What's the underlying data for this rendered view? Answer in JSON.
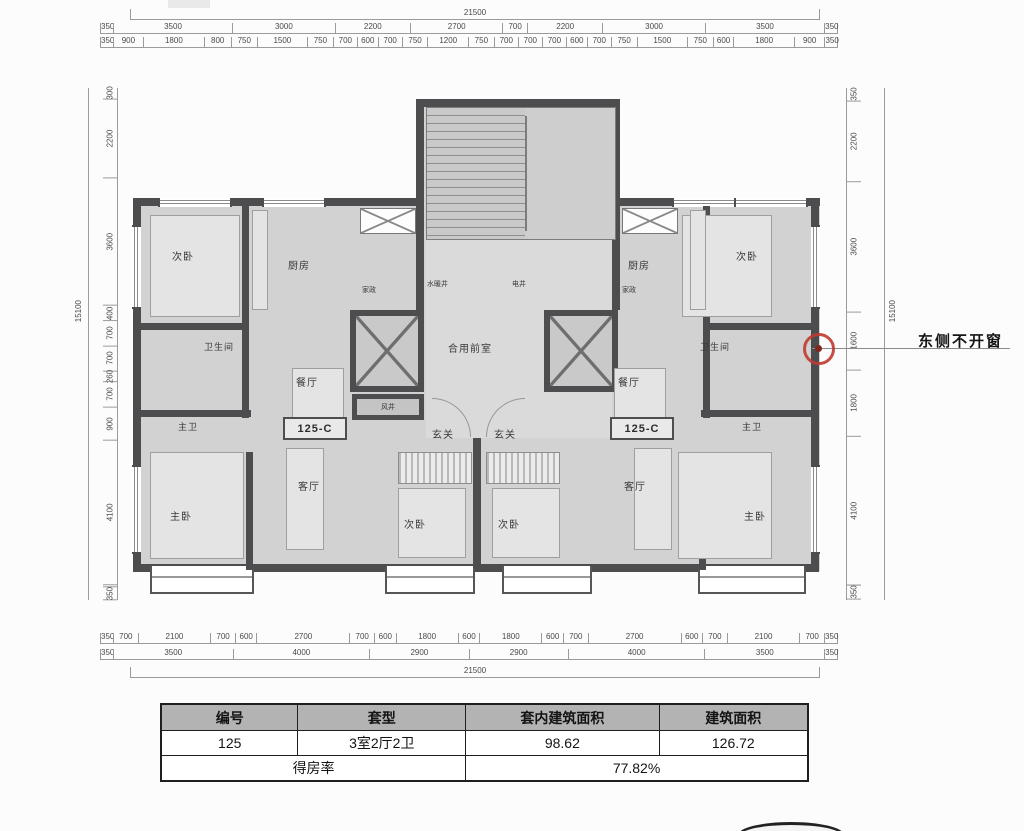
{
  "dims": {
    "top": {
      "total": "21500",
      "row2": [
        "350",
        "3500",
        "3000",
        "2200",
        "2700",
        "700",
        "2200",
        "3000",
        "3500",
        "350"
      ],
      "row3": [
        "350",
        "900",
        "1800",
        "800",
        "750",
        "1500",
        "750",
        "700",
        "600",
        "700",
        "750",
        "1200",
        "750",
        "700",
        "700",
        "700",
        "600",
        "700",
        "750",
        "1500",
        "750",
        "600",
        "1800",
        "900",
        "350"
      ]
    },
    "bottom": {
      "row1": [
        "350",
        "700",
        "2100",
        "700",
        "600",
        "2700",
        "700",
        "600",
        "1800",
        "600",
        "1800",
        "600",
        "700",
        "2700",
        "600",
        "700",
        "2100",
        "700",
        "350"
      ],
      "row2": [
        "350",
        "3500",
        "4000",
        "2900",
        "2900",
        "4000",
        "3500",
        "350"
      ],
      "total": "21500"
    },
    "left": {
      "total": "15100",
      "column": [
        "300",
        "2200",
        "3600",
        "400",
        "700",
        "700",
        "260",
        "700",
        "900",
        "4100",
        "350"
      ]
    },
    "right": {
      "total": "15100",
      "column": [
        "350",
        "2200",
        "3600",
        "1600",
        "1800",
        "4100",
        "350"
      ]
    }
  },
  "plan": {
    "rooms": {
      "bed_top_left": "次卧",
      "bed_top_right": "次卧",
      "kitchen_left": "厨房",
      "kitchen_right": "厨房",
      "housekeeping_left": "家政",
      "housekeeping_right": "家政",
      "plumbing_shaft": "水暖井",
      "electrical_shaft": "电井",
      "bathroom_left": "卫生间",
      "bathroom_right": "卫生间",
      "dining_left": "餐厅",
      "dining_right": "餐厅",
      "shared_lobby": "合用前室",
      "wind_shaft": "风井",
      "master_bath_left": "主卫",
      "master_bath_right": "主卫",
      "foyer_left": "玄关",
      "foyer_right": "玄关",
      "living_left": "客厅",
      "living_right": "客厅",
      "master_bed_left": "主卧",
      "master_bed_right": "主卧",
      "bed_bottom_left": "次卧",
      "bed_bottom_right": "次卧",
      "unit_code_left": "125-C",
      "unit_code_right": "125-C"
    }
  },
  "annotation": {
    "label": "东侧不开窗",
    "circle_color": "#bf3a30"
  },
  "table": {
    "headers": [
      "编号",
      "套型",
      "套内建筑面积",
      "建筑面积"
    ],
    "row": [
      "125",
      "3室2厅2卫",
      "98.62",
      "126.72"
    ],
    "footer_label": "得房率",
    "footer_value": "77.82%"
  },
  "colors": {
    "wall": "#4d4d4f",
    "floor": "#d2d2d2",
    "accent_red": "#bf3a30",
    "table_header_bg": "#b3b3b3"
  }
}
